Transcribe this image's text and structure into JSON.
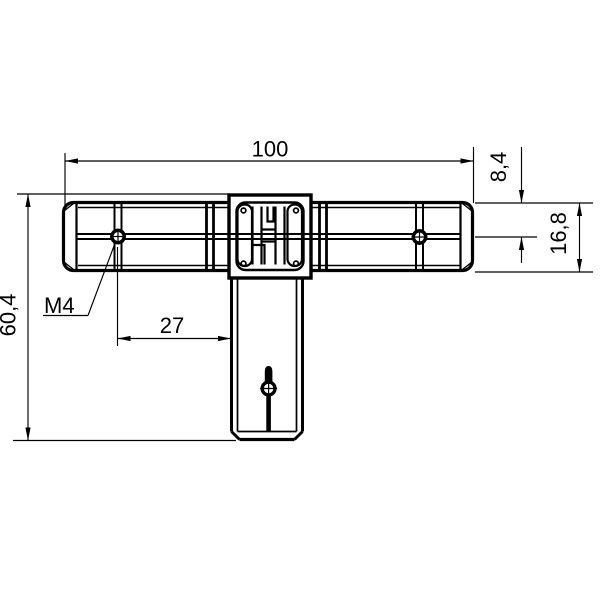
{
  "canvas": {
    "background": "#ffffff",
    "line_color": "#000000"
  },
  "dimensions": {
    "overall_length": {
      "value": "100"
    },
    "hole_offset": {
      "value": "8,4"
    },
    "profile_height": {
      "value": "16,8"
    },
    "overall_height": {
      "value": "60,4"
    },
    "hole_spacing": {
      "value": "27"
    },
    "thread": {
      "value": "M4"
    }
  }
}
